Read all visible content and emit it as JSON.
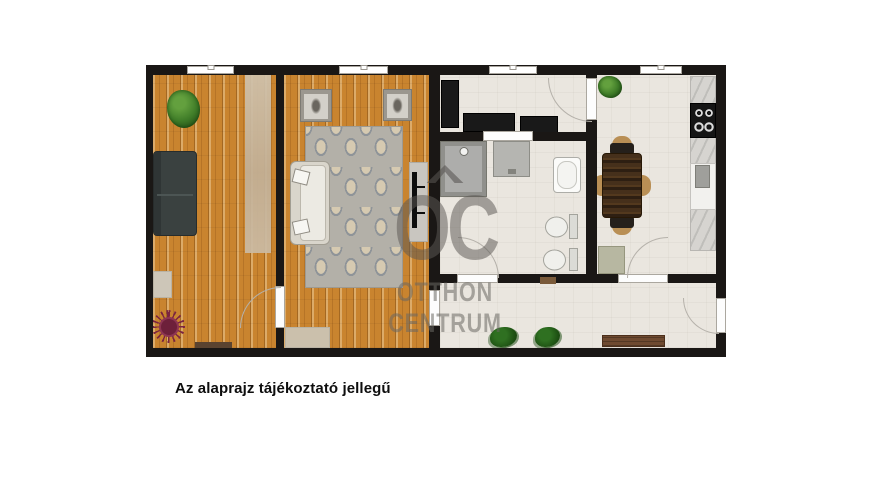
{
  "caption": {
    "text": "Az alaprajz tájékoztató jellegű"
  },
  "watermark": {
    "monogram": "OC",
    "line1": "OTTHON",
    "line2": "CENTRUM",
    "color": "#6a6763"
  },
  "colors": {
    "wall": "#1a1715",
    "wood_floor": "#c9842f",
    "tile_floor": "#eae6df",
    "damask_rug_base": "#b3b0a8",
    "damask_rug_pattern": "#d8cbb1",
    "dark_sofa": "#3a4140",
    "light_sofa": "#d9d5cb",
    "plant_green": "#3f7c28",
    "spike_rug_red": "#7b2440",
    "dining_table": "#46301b",
    "bench": "#6f4a30",
    "counter_marble": "#d6d4d0",
    "appliance_black": "#151515",
    "fixture_white": "#f0f0ec",
    "door_arc": "#b5b1aa"
  },
  "plan": {
    "rooms": [
      {
        "name": "bedroom",
        "floor": "wood"
      },
      {
        "name": "living-room",
        "floor": "wood"
      },
      {
        "name": "hallway",
        "floor": "tile"
      },
      {
        "name": "bathroom",
        "floor": "tile"
      },
      {
        "name": "kitchen-dining",
        "floor": "tile"
      },
      {
        "name": "entry-corridor",
        "floor": "tile"
      }
    ],
    "objects": [
      "potted-plant",
      "dark-sofa",
      "runner-rug",
      "small-rug",
      "spike-round-rug",
      "doormat",
      "framed-portrait",
      "framed-portrait",
      "damask-rug",
      "light-sofa",
      "tv-console",
      "tv",
      "wardrobe",
      "sideboard",
      "sideboard",
      "shower",
      "washing-machine",
      "bathtub",
      "toilet",
      "bidet",
      "dining-table",
      "chairs",
      "kitchen-counter",
      "cooktop",
      "sink",
      "cabinet",
      "floor-plants",
      "bench",
      "windows",
      "door-arcs"
    ]
  }
}
